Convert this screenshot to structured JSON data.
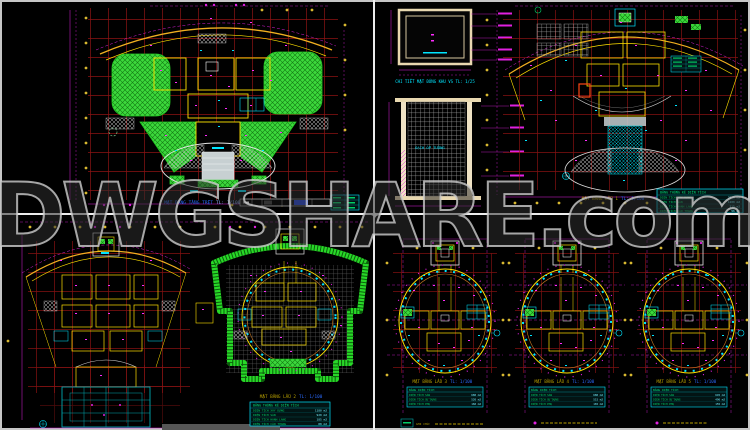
{
  "watermark": {
    "text": "DWGSHARE.com"
  },
  "colors": {
    "background": "#000000",
    "grid_red": "#9c1414",
    "dimension_magenta": "#e020e0",
    "wall_yellow": "#ffe000",
    "arc_orange": "#f0b020",
    "lawn_green": "#3cd83c",
    "accent_cyan": "#00e5ff",
    "legend_green": "#00cc66",
    "title_blue": "#2b6bff",
    "title_olive": "#b8a000",
    "detail_cream": "#efe2c4",
    "watermark_gray": "#cfcfcf"
  },
  "sheets": {
    "ground_floor": {
      "title": "MẶT BẰNG TẦNG TRỆT",
      "scale": "TL: 1/100"
    },
    "level1": {
      "detail_top_title": "CHI TIẾT MẶT ĐỨNG KHU VS TL: 1/25",
      "detail_bottom_label": "GẠCH ỐP TƯỜNG",
      "title": "MẶT BẰNG LẦU 1",
      "scale": "TL: 1/100",
      "legend": {
        "header": "BẢNG THỐNG KÊ DIỆN TÍCH",
        "rows": [
          {
            "label": "DIỆN TÍCH XÂY DỰNG",
            "value": "2150 m2"
          },
          {
            "label": "DIỆN TÍCH SÀN",
            "value": "1280 m2"
          },
          {
            "label": "DIỆN TÍCH HÀNH LANG",
            "value": "215 m2"
          },
          {
            "label": "DIỆN TÍCH CẦU THANG",
            "value": "96 m2"
          }
        ]
      }
    },
    "level2": {
      "title": "MẶT BẰNG LẦU 2",
      "scale": "TL: 1/100",
      "legend": {
        "header": "BẢNG THỐNG KÊ DIỆN TÍCH",
        "rows": [
          {
            "label": "DIỆN TÍCH XÂY DỰNG",
            "value": "1180 m2"
          },
          {
            "label": "DIỆN TÍCH SÀN",
            "value": "920 m2"
          },
          {
            "label": "DIỆN TÍCH HÀNH LANG",
            "value": "185 m2"
          },
          {
            "label": "DIỆN TÍCH CẦU THANG",
            "value": "88 m2"
          }
        ]
      }
    },
    "tower_levels": [
      {
        "title": "MẶT BẰNG LẦU 3",
        "scale": "TL: 1/100",
        "legend": {
          "header": "BẢNG DIỆN TÍCH",
          "rows": [
            {
              "label": "DIỆN TÍCH SÀN",
              "value": "680 m2"
            },
            {
              "label": "DIỆN TÍCH SỬ DỤNG",
              "value": "520 m2"
            },
            {
              "label": "DIỆN TÍCH PHỤ",
              "value": "160 m2"
            }
          ]
        }
      },
      {
        "title": "MẶT BẰNG LẦU 4",
        "scale": "TL: 1/100",
        "legend": {
          "header": "BẢNG DIỆN TÍCH",
          "rows": [
            {
              "label": "DIỆN TÍCH SÀN",
              "value": "680 m2"
            },
            {
              "label": "DIỆN TÍCH SỬ DỤNG",
              "value": "515 m2"
            },
            {
              "label": "DIỆN TÍCH PHỤ",
              "value": "165 m2"
            }
          ]
        }
      },
      {
        "title": "MẶT BẰNG LẦU 5",
        "scale": "TL: 1/100",
        "legend": {
          "header": "BẢNG DIỆN TÍCH",
          "rows": [
            {
              "label": "DIỆN TÍCH SÀN",
              "value": "645 m2"
            },
            {
              "label": "DIỆN TÍCH SỬ DỤNG",
              "value": "490 m2"
            },
            {
              "label": "DIỆN TÍCH PHỤ",
              "value": "155 m2"
            }
          ]
        }
      }
    ],
    "note_label": "GHI CHÚ:"
  }
}
